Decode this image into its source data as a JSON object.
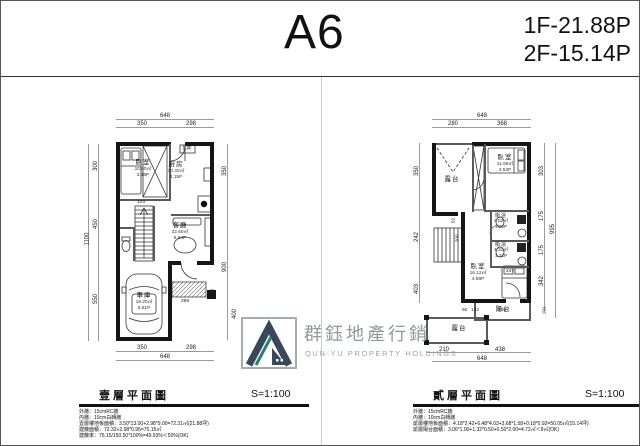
{
  "header": {
    "unit": "A6",
    "area_1f": "1F-21.88P",
    "area_2f": "2F-15.14P"
  },
  "logo": {
    "zh": "群鈺地產行銷",
    "en": "QUN-YU PROPERTY HOLDINGS",
    "colors": {
      "dark": "#39475a",
      "teal": "#2e7d6e",
      "text": "#8e9a99"
    }
  },
  "plan1": {
    "caption": "壹層平面圖",
    "scale": "S=1:100",
    "notes": [
      "外牆：15cmRC牆",
      "內牆：10cm白磚牆",
      "壹層樓地板面積：3.50*13.00+2.98*9.00=72.31㎡(21.88坪)",
      "建蔽面積：72.32+2.98*0.95=75.15㎡",
      "建蔽率：75.15/150.50*100%=49.93%＜50%(OK)"
    ],
    "rooms": {
      "bedroom": {
        "name": "臥室",
        "m2": "10.50㎡",
        "p": "3.18P"
      },
      "kitchen": {
        "name": "廚房",
        "m2": "10.40㎡",
        "p": "3.15P"
      },
      "living": {
        "name": "客廳",
        "m2": "22.60㎡",
        "p": "6.84P"
      },
      "garage": {
        "name": "車庫",
        "m2": "19.20㎡",
        "p": "5.81P"
      }
    },
    "small_labels": {
      "gas": "瓦斯"
    },
    "dims": {
      "top_total": "648",
      "top_a": "350",
      "top_b": "298",
      "left_outer": "1100",
      "left_a": "300",
      "left_b": "450",
      "left_c": "550",
      "right_a": "350",
      "right_b": "900",
      "right_c": "95",
      "right_d": "400",
      "bottom_a": "350",
      "bottom_b": "298",
      "bottom_total": "648",
      "stair": "103",
      "porch": "298"
    }
  },
  "plan2": {
    "caption": "貳層平面圖",
    "scale": "S=1:100",
    "notes": [
      "外牆：15cmRC牆",
      "內牆：10cm白磚牆",
      "貳層樓地板面積：4.18*2.42+6.48*4.03+3.68*1.58+0.18*0.92=50.05㎡(15.14坪)",
      "貳層陽台面積：3.06*1.00+1.32*0.50+0.50*2.00=4.72㎡＜8㎡(OK)"
    ],
    "rooms": {
      "terrace_top": {
        "name": "露台"
      },
      "bedroom_top": {
        "name": "臥室",
        "m2": "11.66㎡",
        "p": "3.53P"
      },
      "bath1": {
        "name": "衛浴",
        "m2": "4.02㎡",
        "p": "1.22P"
      },
      "bath2": {
        "name": "衛浴",
        "m2": "4.32㎡",
        "p": "1.31P"
      },
      "bedroom_low": {
        "name": "臥室",
        "m2": "16.12㎡",
        "p": "4.88P"
      },
      "balcony": {
        "name": "陽台"
      },
      "terrace_bottom": {
        "name": "露台"
      }
    },
    "dims": {
      "top_total": "648",
      "top_a": "280",
      "top_b": "368",
      "left_a": "350",
      "left_b": "242",
      "left_c": "403",
      "right_outer": "995",
      "right_a": "303",
      "right_b": "175",
      "right_c": "175",
      "right_d": "342",
      "right_e": "101",
      "bottom_a": "210",
      "bottom_b": "438",
      "bottom_total": "648",
      "mid_a": "50",
      "mid_b": "132",
      "mid_c": "306",
      "bath": "247",
      "inner_a": "200",
      "inner_b": "92"
    }
  }
}
